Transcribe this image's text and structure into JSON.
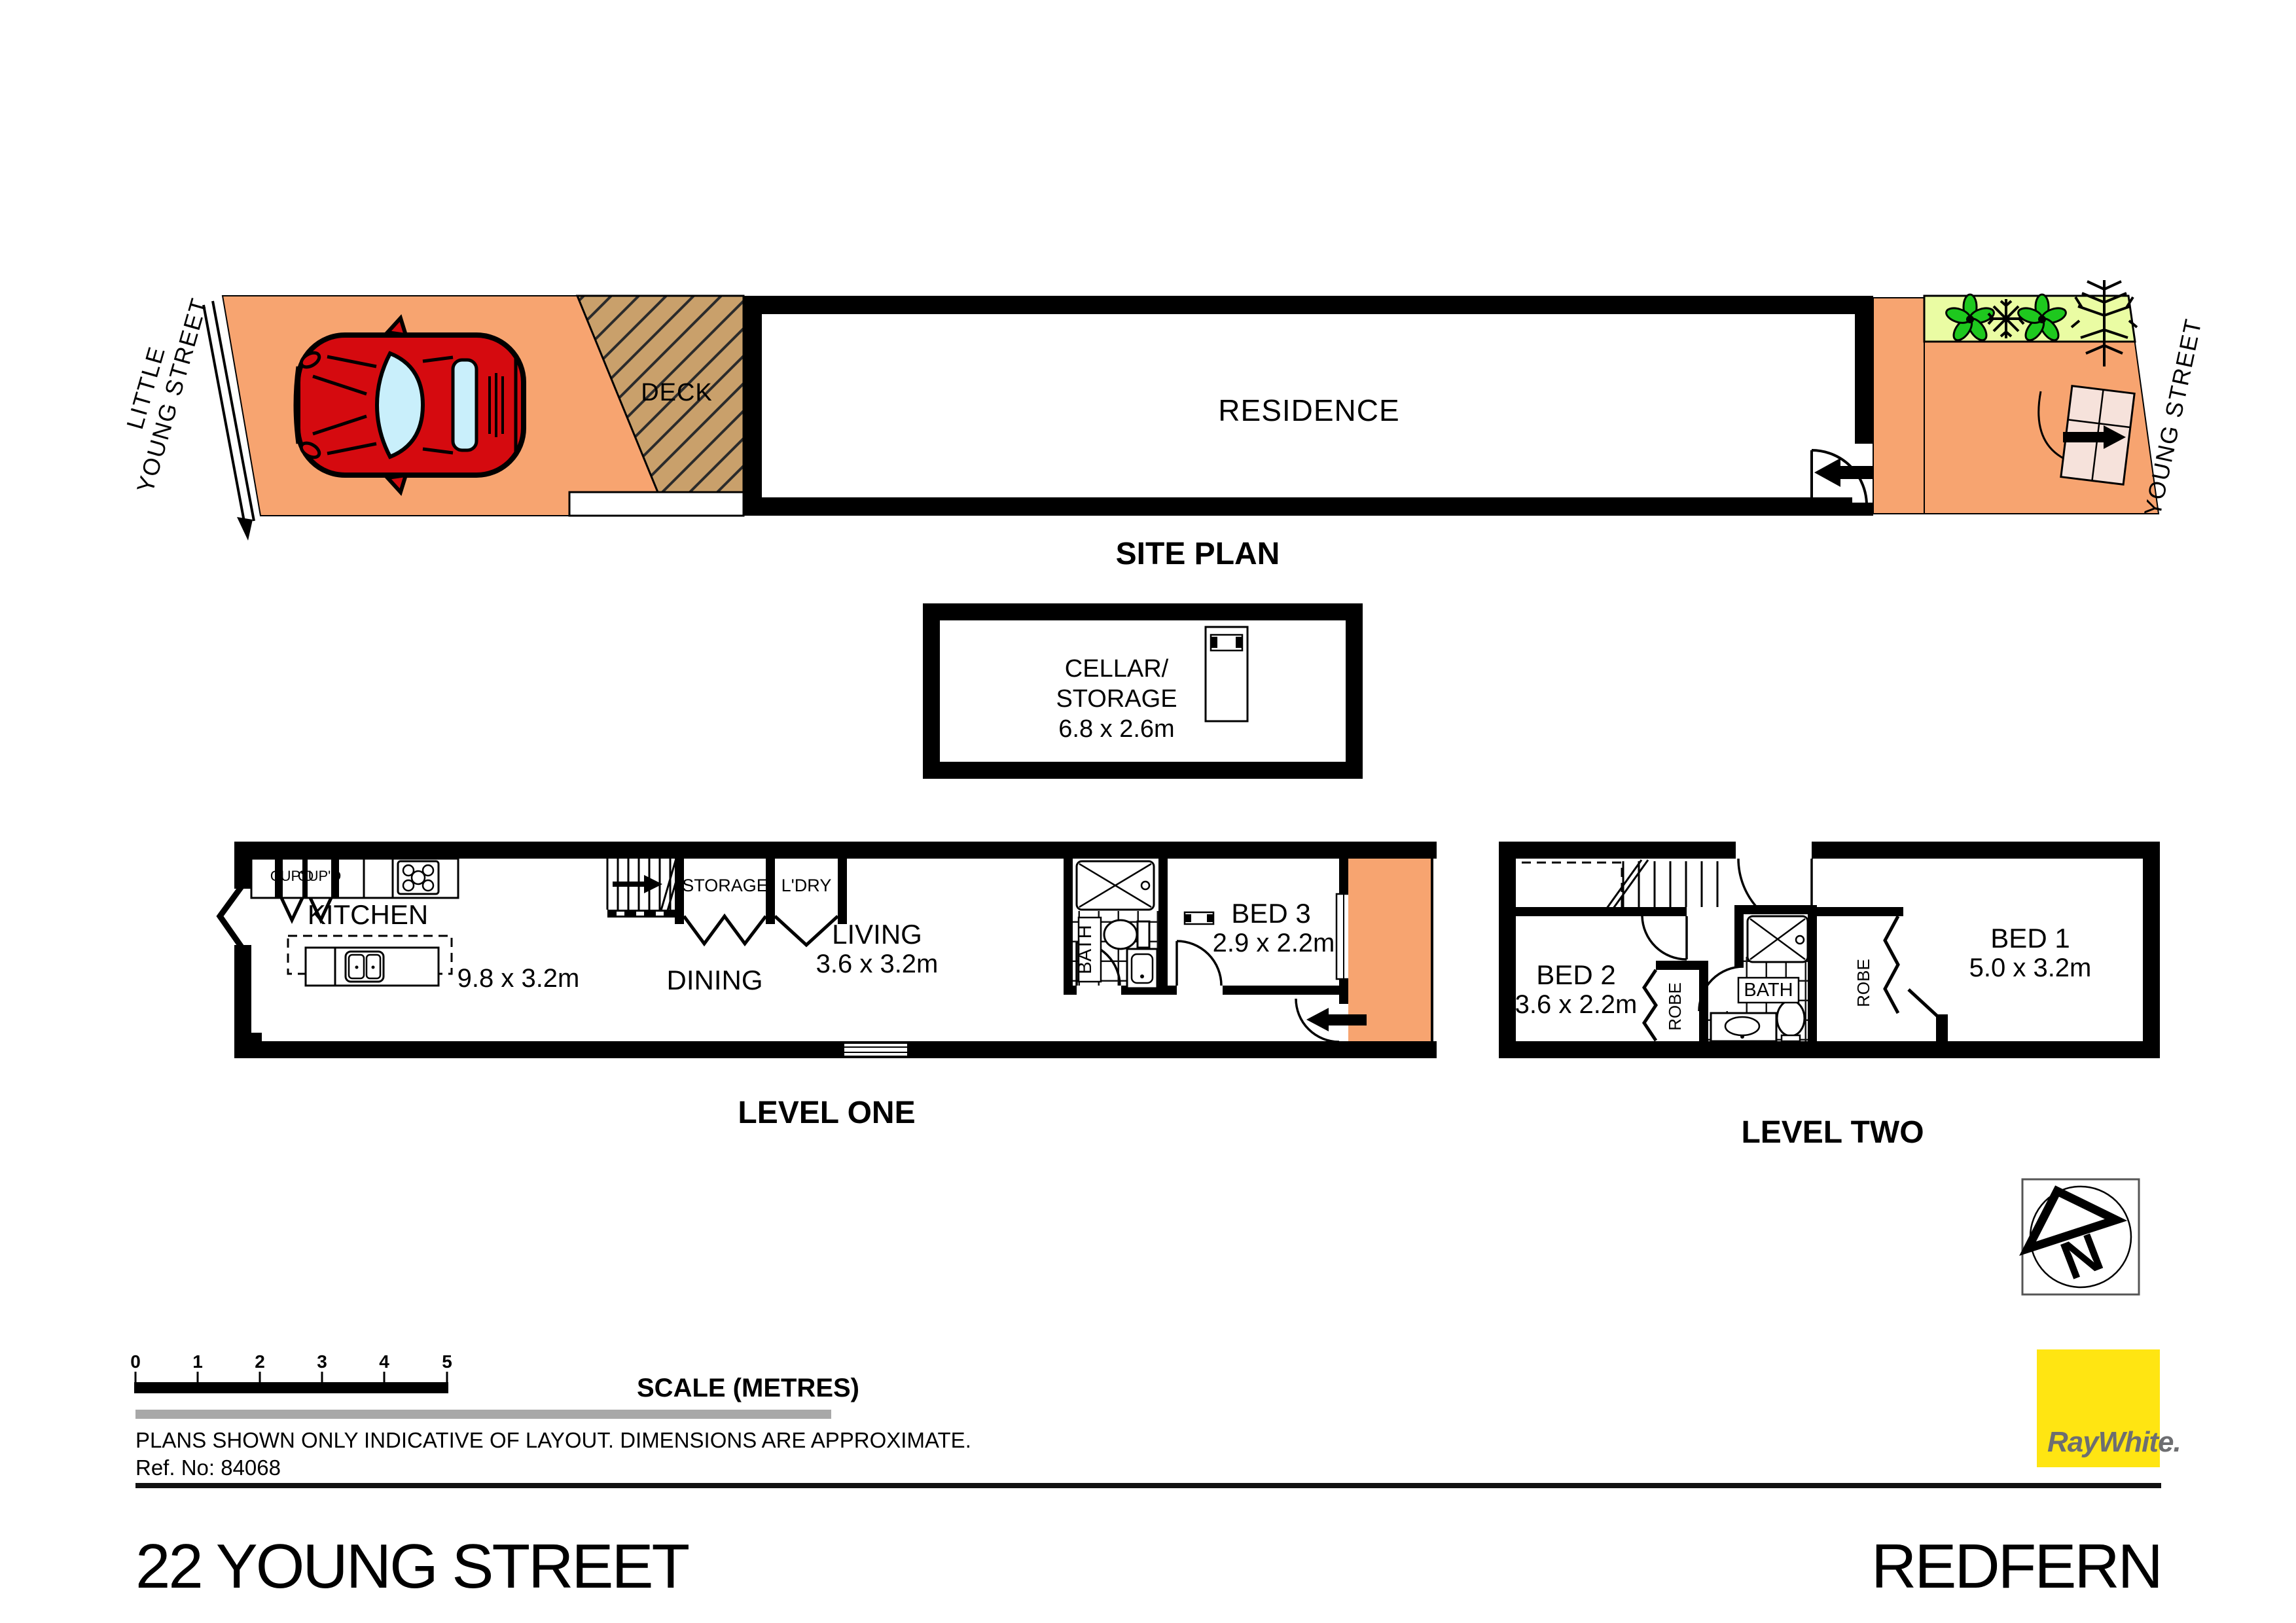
{
  "site_plan": {
    "caption": "SITE PLAN",
    "left_street": {
      "line1": "LITTLE",
      "line2": "YOUNG STREET"
    },
    "right_street": "YOUNG STREET",
    "deck": "DECK",
    "residence": "RESIDENCE"
  },
  "cellar": {
    "line1": "CELLAR/",
    "line2": "STORAGE",
    "dim": "6.8 x 2.6m"
  },
  "level_one": {
    "caption": "LEVEL ONE",
    "cupboard1": "CUP'D",
    "cupboard2": "CUP'D",
    "kitchen": "KITCHEN",
    "kitchen_dim": "9.8 x 3.2m",
    "storage": "STORAGE",
    "laundry": "L'DRY",
    "dining": "DINING",
    "living": "LIVING",
    "living_dim": "3.6 x 3.2m",
    "bath": "BATH",
    "bed3": "BED 3",
    "bed3_dim": "2.9 x 2.2m"
  },
  "level_two": {
    "caption": "LEVEL TWO",
    "bed2": "BED 2",
    "bed2_dim": "3.6 x 2.2m",
    "bed1": "BED 1",
    "bed1_dim": "5.0 x 3.2m",
    "bath": "BATH",
    "robe1": "ROBE",
    "robe2": "ROBE"
  },
  "north": {
    "letter": "N"
  },
  "scale_bar": {
    "ticks": [
      "0",
      "1",
      "2",
      "3",
      "4",
      "5"
    ],
    "label": "SCALE (METRES)"
  },
  "notes": {
    "line1": "PLANS SHOWN ONLY INDICATIVE OF LAYOUT.  DIMENSIONS ARE APPROXIMATE.",
    "line2": "Ref. No: 84068"
  },
  "footer": {
    "address": "22 YOUNG STREET",
    "suburb": "REDFERN"
  },
  "brand": {
    "name": "RayWhite."
  },
  "colors": {
    "paving": "#F7A470",
    "deck": "#C9A06B",
    "garden": "#EAFCA3",
    "car_red": "#D50A0F",
    "glass": "#C9EFFB",
    "gate": "#F6E2DB",
    "logo_yellow": "#FFE512",
    "logo_gray": "#6D6E71",
    "bar_gray": "#A8A8A8"
  }
}
